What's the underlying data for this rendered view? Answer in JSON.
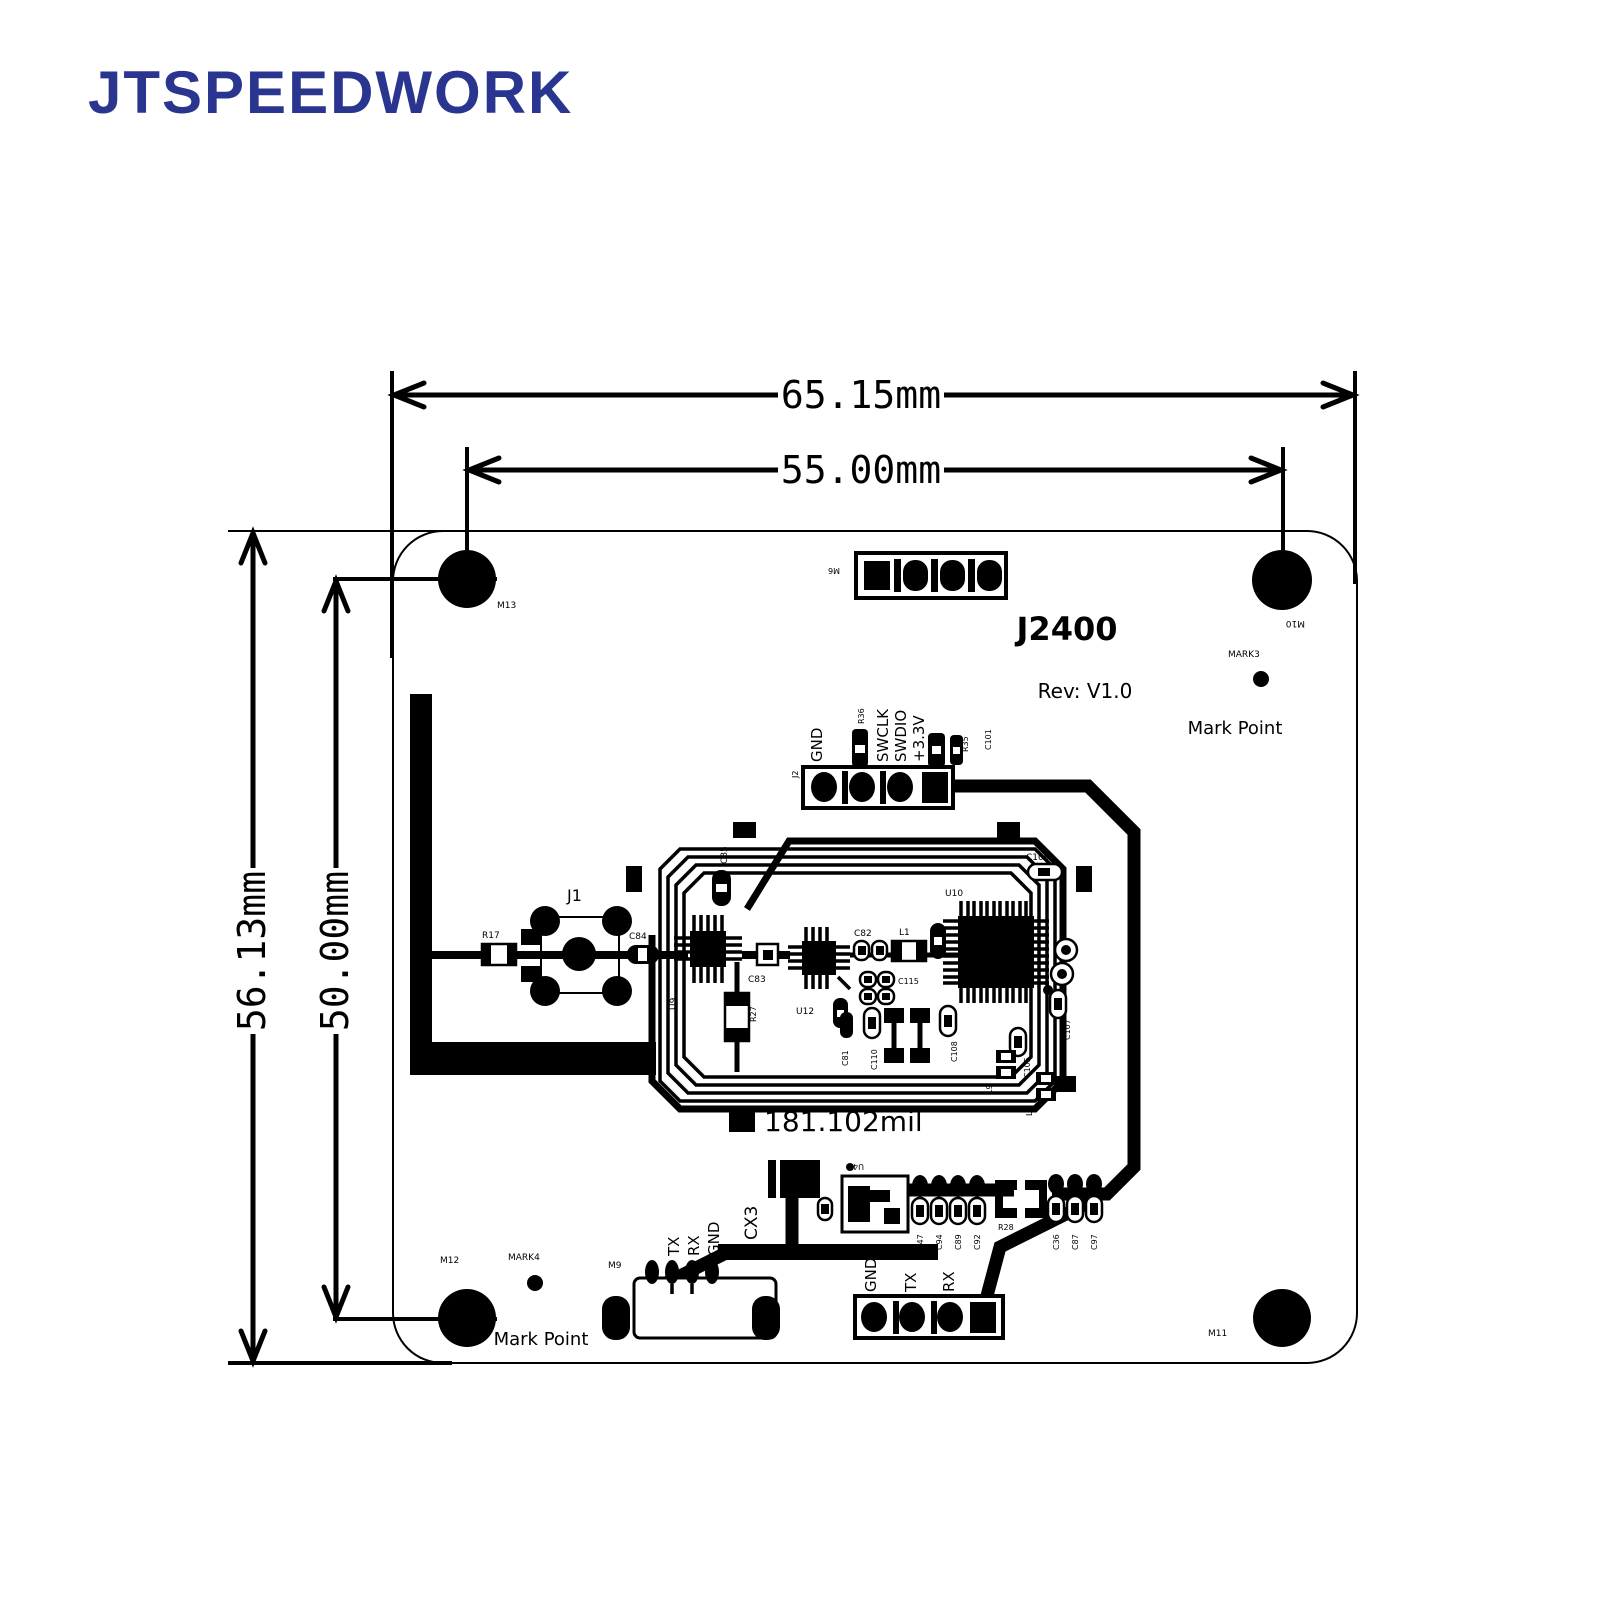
{
  "logo": {
    "text": "JTSPEEDWORK",
    "color": "#2a3590"
  },
  "dimensions": {
    "outer_width": "65.15mm",
    "inner_width": "55.00mm",
    "outer_height": "56.13mm",
    "inner_height": "50.00mm"
  },
  "board": {
    "model": "J2400",
    "revision": "Rev: V1.0",
    "trace_note": "181.102mil"
  },
  "fiducials": {
    "mark3": {
      "label": "MARK3",
      "caption": "Mark Point"
    },
    "mark4": {
      "label": "MARK4",
      "caption": "Mark Point"
    }
  },
  "holes": {
    "top_left": "M13",
    "top_right": "M10",
    "bottom_left": "M12",
    "bottom_right": "M11"
  },
  "connectors": {
    "m6": "M6",
    "j1": "J1",
    "j2": {
      "label": "J2",
      "pins": [
        "GND",
        "SWCLK",
        "SWDIO",
        "+3.3V"
      ]
    },
    "m9": {
      "label": "M9",
      "pins": [
        "TX",
        "RX",
        "GND"
      ]
    },
    "uart": {
      "pins": [
        "GND",
        "TX",
        "RX"
      ]
    },
    "cx3": "CX3",
    "u4": "U4"
  },
  "components": {
    "r17": "R17",
    "c84": "C84",
    "c85": "C85",
    "u9": "U9",
    "r27": "R27",
    "c83": "C83",
    "u12": "U12",
    "c82": "C82",
    "l1": "L1",
    "u10": "U10",
    "c109": "C109",
    "c115": "C115",
    "c110": "C110",
    "c81": "C81",
    "c108": "C108",
    "c107": "C107",
    "c105": "C105",
    "l8": "L8",
    "l9": "L9",
    "r36": "R36",
    "r35": "R35",
    "c101": "C101",
    "c47": "C47",
    "c94": "C94",
    "c89": "C89",
    "c92": "C92",
    "r28": "R28",
    "c36": "C36",
    "c87": "C87",
    "c97": "C97"
  }
}
